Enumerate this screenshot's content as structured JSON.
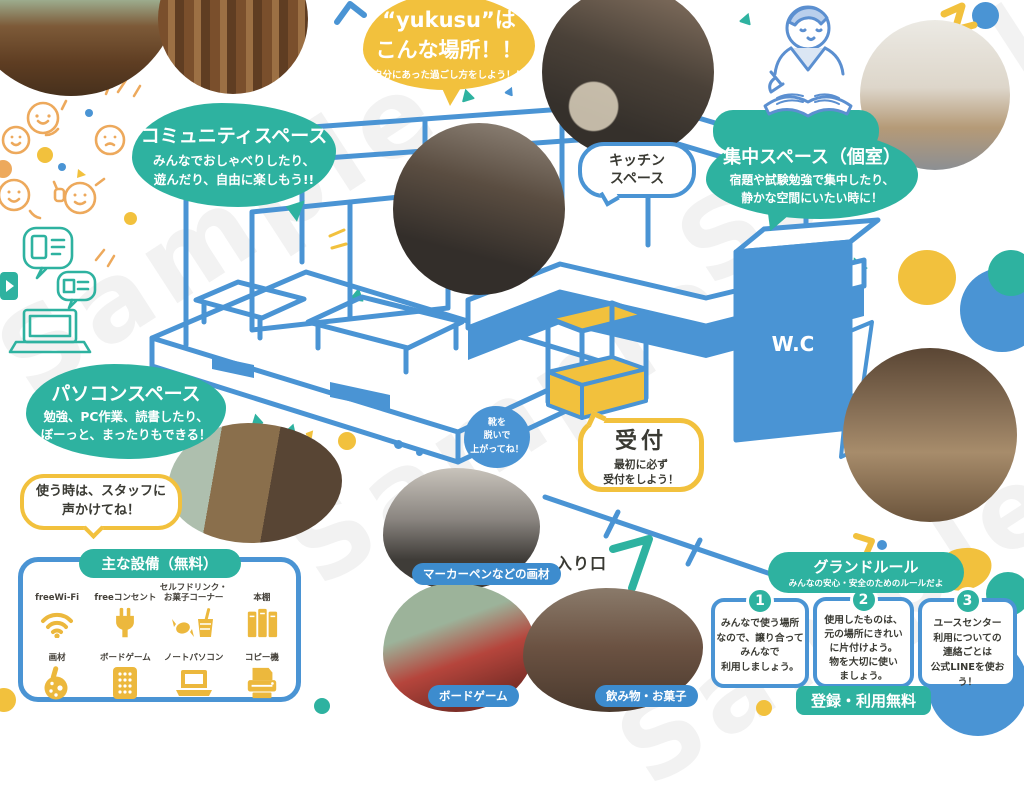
{
  "watermark": "Sample",
  "title_bubble": {
    "line1": "“yukusu”は",
    "line2": "こんな場所！！",
    "subtitle": "-自分にあった過ごし方をしよう！！-"
  },
  "spaces": {
    "community": {
      "title": "コミュニティスペース",
      "desc": "みんなでおしゃべりしたり、\n遊んだり、自由に楽しもう!!"
    },
    "kitchen": {
      "title": "キッチン\nスペース"
    },
    "focus": {
      "title": "集中スペース（個室）",
      "desc": "宿題や試験勉強で集中したり、\n静かな空間にいたい時に！"
    },
    "pc": {
      "title": "パソコンスペース",
      "desc": "勉強、PC作業、読書したり、\nぼーっと、まったりもできる！"
    }
  },
  "callouts": {
    "staff": "使う時は、スタッフに\n声かけてね！",
    "shoes": "靴を\n脱いで\n上がってね！",
    "reception_title": "受付",
    "reception_desc": "最初に必ず\n受付をしよう！",
    "wc": "W.C",
    "entrance": "入り口"
  },
  "equipment": {
    "title": "主な設備（無料）",
    "items": [
      {
        "label": "freeWi-Fi",
        "icon": "wifi-icon"
      },
      {
        "label": "freeコンセント",
        "icon": "power-plug-icon"
      },
      {
        "label": "セルフドリンク・\nお菓子コーナー",
        "icon": "drink-snack-icon"
      },
      {
        "label": "本棚",
        "icon": "bookshelf-icon"
      },
      {
        "label": "画材",
        "icon": "art-supplies-icon"
      },
      {
        "label": "ボードゲーム",
        "icon": "board-game-icon"
      },
      {
        "label": "ノートパソコン",
        "icon": "laptop-icon"
      },
      {
        "label": "コピー機",
        "icon": "copier-icon"
      }
    ]
  },
  "photo_labels": {
    "markers": "マーカーペンなどの画材",
    "board_game": "ボードゲーム",
    "snacks": "飲み物・お菓子"
  },
  "ground_rules": {
    "title": "グランドルール",
    "subtitle": "みんなの安心・安全のためのルールだよ",
    "rules": [
      {
        "number": "1",
        "text": "みんなで使う場所\nなので、譲り合って\nみんなで\n利用しましょう。"
      },
      {
        "number": "2",
        "text": "使用したものは、\n元の場所にきれい\nに片付けよう。\n物を大切に使い\nましょう。"
      },
      {
        "number": "3",
        "text": "ユースセンター\n利用についての\n連絡ごとは\n公式LINEを使おう！"
      }
    ],
    "footer": "登録・利用無料"
  }
}
